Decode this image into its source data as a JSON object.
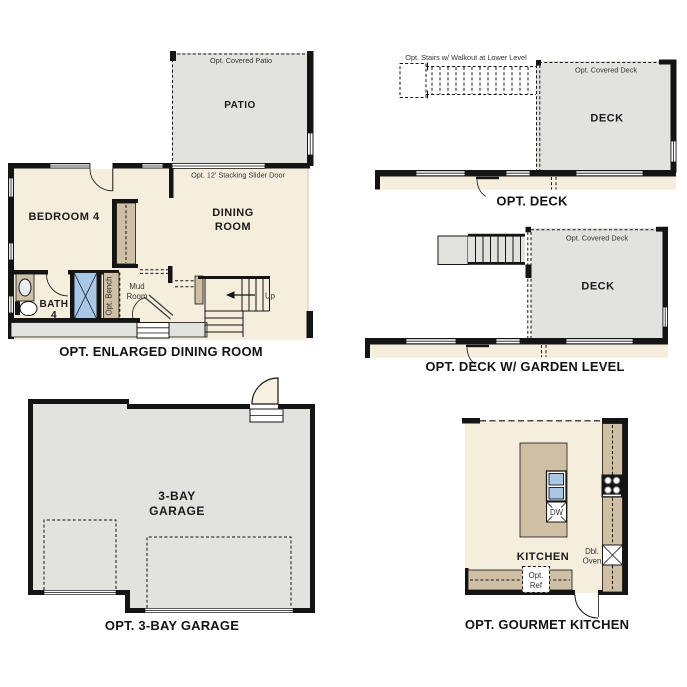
{
  "document_title": "Floor Plan Options Sheet",
  "palette": {
    "wall": "#141414",
    "floor_cream": "#f6eedd",
    "hardscape_gray": "#e2e2df",
    "cabinet_tan": "#cfc0a5",
    "fixture_blue": "#a9c7e6",
    "annotation_text": "#333333",
    "label_text": "#1a1a1a"
  },
  "plans": {
    "enlarged_dining_room": {
      "caption": "OPT. ENLARGED DINING ROOM",
      "covered_patio_label": "Opt. Covered Patio",
      "patio_label": "PATIO",
      "slider_door_label": "Opt. 12' Stacking Slider Door",
      "bedroom_label": "BEDROOM 4",
      "dining_label_line1": "DINING",
      "dining_label_line2": "ROOM",
      "bath_label_line1": "BATH",
      "bath_label_line2": "4",
      "bench_label": "Opt. Bench",
      "mud_label_line1": "Mud",
      "mud_label_line2": "Room",
      "up_label": "Up"
    },
    "deck": {
      "caption": "OPT. DECK",
      "stairs_label": "Opt. Stairs w/ Walkout at Lower Level",
      "covered_deck_label": "Opt. Covered Deck",
      "deck_label": "DECK"
    },
    "deck_garden_level": {
      "caption": "OPT. DECK W/ GARDEN LEVEL",
      "covered_deck_label": "Opt. Covered Deck",
      "deck_label": "DECK"
    },
    "garage": {
      "caption": "OPT. 3-BAY GARAGE",
      "label_line1": "3-BAY",
      "label_line2": "GARAGE"
    },
    "gourmet_kitchen": {
      "caption": "OPT. GOURMET KITCHEN",
      "kitchen_label": "KITCHEN",
      "dw_label": "DW",
      "dbl_oven_line1": "Dbl.",
      "dbl_oven_line2": "Oven",
      "opt_ref_line1": "Opt.",
      "opt_ref_line2": "Ref"
    }
  }
}
